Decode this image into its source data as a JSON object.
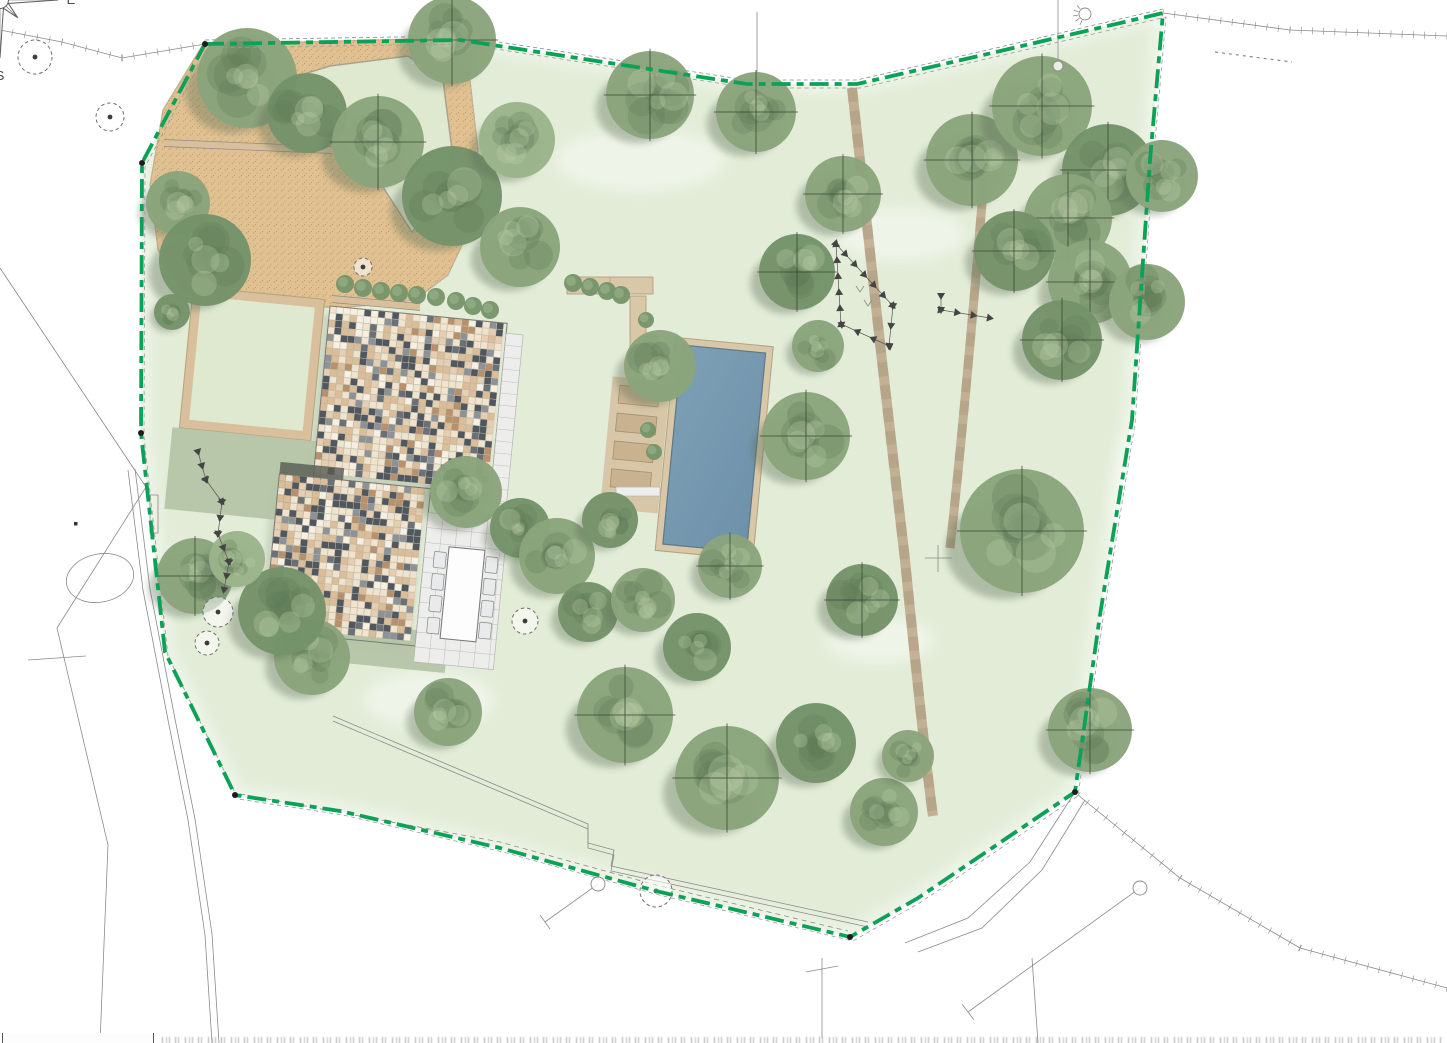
{
  "plan": {
    "kind": "landscape-garden-site-plan",
    "canvas": {
      "width": 1447,
      "height": 1043
    }
  },
  "compass": {
    "cx": 1362,
    "cy": 90,
    "rotation": -57,
    "r_long": 58,
    "r_short": 25,
    "labels": {
      "north": "Nord",
      "east": "E",
      "south": "S",
      "west": "O"
    }
  },
  "colors": {
    "lawn": "#e2ecd7",
    "lawn_island": "#dfe9d0",
    "boundary_green": "#0aa257",
    "boundary_companion": "#9a9a96",
    "gravel": "#e0c191",
    "gravel_edge": "#c3af92",
    "curb": "#a9a193",
    "sage": "#b5c4a6",
    "wall_tan": "#d9bf9b",
    "terrace": "#ededeb",
    "terrace_line": "#bdbdb9",
    "pool_water_a": "#7da0b6",
    "pool_water_b": "#6d91a9",
    "pool_edge": "#5d7888",
    "pool_deck": "#d9c8a8",
    "lounger": "#c9b28f",
    "lounger_edge": "#a58f6d",
    "path": "#b59c7d",
    "tree_base": "#8aa47c",
    "tree_dark": "#75936a",
    "tree_light": "#9bb48b",
    "tree_blotch": "#5f7a55",
    "tree_highlight": "#bdd2a8",
    "tree_shadow": "#5c6e57",
    "roof_palette": [
      "#f1e3cd",
      "#ddbd98",
      "#e7cdb2",
      "#52575f",
      "#8e9297",
      "#b9906b",
      "#f7efe2",
      "#6b7078"
    ],
    "roof_weights": [
      22,
      20,
      14,
      16,
      6,
      8,
      8,
      6
    ],
    "survey_line": "#8a8a8a",
    "marker": "#444444",
    "compass_line": "#5f5f5f"
  },
  "boundary": {
    "points": [
      [
        205,
        44
      ],
      [
        460,
        40
      ],
      [
        747,
        84
      ],
      [
        857,
        84
      ],
      [
        983,
        55
      ],
      [
        1163,
        13
      ],
      [
        1150,
        160
      ],
      [
        1132,
        420
      ],
      [
        1100,
        615
      ],
      [
        1075,
        792
      ],
      [
        918,
        898
      ],
      [
        850,
        937
      ],
      [
        656,
        891
      ],
      [
        500,
        848
      ],
      [
        340,
        811
      ],
      [
        235,
        795
      ],
      [
        165,
        652
      ],
      [
        141,
        433
      ],
      [
        142,
        163
      ]
    ],
    "vertex_dots": [
      [
        205,
        44
      ],
      [
        142,
        163
      ],
      [
        141,
        433
      ],
      [
        235,
        795
      ],
      [
        850,
        937
      ],
      [
        1075,
        792
      ]
    ],
    "dash": "19 6 7 6"
  },
  "lawn_patches": [
    [
      640,
      160,
      170,
      62
    ],
    [
      900,
      235,
      130,
      52
    ],
    [
      1155,
      500,
      85,
      170
    ],
    [
      430,
      700,
      130,
      55
    ],
    [
      880,
      640,
      110,
      45
    ]
  ],
  "driveway": {
    "outline": [
      [
        202,
        46
      ],
      [
        300,
        42
      ],
      [
        448,
        38
      ],
      [
        470,
        80
      ],
      [
        478,
        150
      ],
      [
        470,
        228
      ],
      [
        448,
        275
      ],
      [
        415,
        300
      ],
      [
        340,
        308
      ],
      [
        255,
        302
      ],
      [
        185,
        292
      ],
      [
        158,
        250
      ],
      [
        150,
        185
      ],
      [
        163,
        110
      ]
    ],
    "island": [
      [
        258,
        88
      ],
      [
        330,
        66
      ],
      [
        408,
        56
      ],
      [
        443,
        80
      ],
      [
        452,
        150
      ],
      [
        438,
        205
      ],
      [
        412,
        232
      ],
      [
        372,
        170
      ],
      [
        318,
        122
      ]
    ],
    "walls": [
      [
        [
          164,
          143
        ],
        [
          332,
          150
        ]
      ],
      [
        [
          332,
          299
        ],
        [
          420,
          307
        ]
      ]
    ]
  },
  "house": {
    "origin": [
      330,
      306
    ],
    "rotation": 5.6,
    "tile": 7,
    "roof_a": [
      0,
      0,
      178,
      172
    ],
    "roof_b": [
      -34,
      172,
      152,
      158
    ],
    "terrace_a": [
      178,
      10,
      17,
      170
    ],
    "terrace_b": [
      118,
      196,
      80,
      150
    ],
    "dark_strip": [
      -34,
      160,
      64,
      14
    ],
    "courtyard_outer": [
      -138,
      -6,
      132,
      142
    ],
    "courtyard_inner": [
      -129,
      3,
      114,
      124
    ],
    "sage_1": [
      -145,
      136,
      154,
      82
    ],
    "sage_2": [
      14,
      314,
      136,
      40
    ],
    "table": [
      142,
      228,
      36,
      92
    ],
    "chairs_y": [
      234,
      256,
      278,
      300
    ]
  },
  "pool": {
    "origin": [
      682,
      345
    ],
    "rotation": 5.5,
    "water": [
      0,
      0,
      84,
      200
    ],
    "deck": [
      -7,
      -7,
      98,
      214
    ],
    "lounger_deck": [
      -66,
      38,
      58,
      132
    ],
    "loungers": [
      [
        -58,
        46,
        40,
        18
      ],
      [
        -58,
        74,
        40,
        18
      ],
      [
        -58,
        102,
        40,
        18
      ],
      [
        -58,
        130,
        40,
        18
      ]
    ],
    "bench_top": [
      567,
      277,
      86,
      17
    ],
    "wall_v": [
      630,
      296,
      16,
      62
    ],
    "step_pad": [
      616,
      487,
      44,
      9
    ]
  },
  "paths": [
    {
      "d": "M852,88 C862,180 888,420 905,560 C918,690 928,780 933,816",
      "w": 10
    },
    {
      "d": "M988,126 C978,260 962,440 950,548",
      "w": 9
    }
  ],
  "trees": {
    "canopy": [
      [
        247,
        78,
        50,
        0,
        0
      ],
      [
        307,
        113,
        40,
        1,
        0
      ],
      [
        378,
        142,
        46,
        0,
        1
      ],
      [
        452,
        196,
        50,
        1,
        0
      ],
      [
        520,
        247,
        40,
        0,
        0
      ],
      [
        452,
        40,
        44,
        0,
        1
      ],
      [
        517,
        140,
        38,
        2,
        0
      ],
      [
        178,
        203,
        32,
        0,
        0
      ],
      [
        205,
        260,
        46,
        1,
        0
      ],
      [
        172,
        312,
        18,
        1,
        0
      ],
      [
        650,
        95,
        44,
        0,
        1
      ],
      [
        756,
        112,
        40,
        0,
        1
      ],
      [
        843,
        194,
        38,
        0,
        1
      ],
      [
        797,
        272,
        38,
        1,
        1
      ],
      [
        818,
        346,
        26,
        0,
        0
      ],
      [
        972,
        160,
        46,
        0,
        1
      ],
      [
        1042,
        106,
        50,
        0,
        1
      ],
      [
        1108,
        170,
        46,
        1,
        1
      ],
      [
        1162,
        176,
        36,
        0,
        0
      ],
      [
        1068,
        218,
        44,
        0,
        1
      ],
      [
        1014,
        251,
        40,
        1,
        1
      ],
      [
        1090,
        282,
        42,
        0,
        1
      ],
      [
        1147,
        302,
        38,
        0,
        0
      ],
      [
        1062,
        340,
        40,
        1,
        1
      ],
      [
        660,
        366,
        36,
        0,
        0
      ],
      [
        806,
        436,
        44,
        0,
        1
      ],
      [
        862,
        600,
        36,
        1,
        1
      ],
      [
        1022,
        531,
        62,
        0,
        1
      ],
      [
        730,
        566,
        32,
        0,
        1
      ],
      [
        466,
        492,
        36,
        0,
        0
      ],
      [
        520,
        528,
        30,
        1,
        0
      ],
      [
        557,
        556,
        38,
        0,
        0
      ],
      [
        610,
        520,
        28,
        1,
        0
      ],
      [
        588,
        612,
        30,
        1,
        0
      ],
      [
        643,
        600,
        32,
        0,
        0
      ],
      [
        697,
        647,
        34,
        1,
        0
      ],
      [
        625,
        715,
        48,
        0,
        1
      ],
      [
        727,
        778,
        52,
        0,
        1
      ],
      [
        816,
        743,
        40,
        1,
        0
      ],
      [
        884,
        812,
        34,
        0,
        0
      ],
      [
        908,
        756,
        26,
        0,
        0
      ],
      [
        1090,
        730,
        42,
        0,
        1
      ],
      [
        448,
        712,
        34,
        0,
        0
      ],
      [
        312,
        657,
        38,
        0,
        0
      ],
      [
        282,
        611,
        44,
        1,
        0
      ],
      [
        195,
        576,
        38,
        0,
        1
      ],
      [
        237,
        559,
        28,
        2,
        0
      ]
    ],
    "outline": [
      [
        35,
        57,
        17
      ],
      [
        110,
        117,
        14
      ],
      [
        363,
        267,
        9
      ],
      [
        525,
        621,
        13
      ],
      [
        218,
        612,
        15
      ],
      [
        207,
        643,
        12
      ],
      [
        656,
        891,
        16
      ]
    ]
  },
  "bush_rows": [
    {
      "r": 9,
      "pts": [
        [
          345,
          284
        ],
        [
          363,
          288
        ],
        [
          381,
          291
        ],
        [
          399,
          293
        ],
        [
          417,
          295
        ],
        [
          436,
          297
        ]
      ]
    },
    {
      "r": 9,
      "pts": [
        [
          456,
          301
        ],
        [
          473,
          306
        ],
        [
          490,
          310
        ]
      ]
    },
    {
      "r": 9,
      "pts": [
        [
          573,
          283
        ],
        [
          590,
          287
        ],
        [
          607,
          291
        ],
        [
          621,
          295
        ]
      ]
    },
    {
      "r": 8,
      "pts": [
        [
          646,
          320
        ],
        [
          651,
          342
        ]
      ]
    },
    {
      "r": 8,
      "pts": [
        [
          648,
          430
        ],
        [
          654,
          452
        ]
      ]
    }
  ],
  "triangle_lines": [
    {
      "p": [
        [
          836,
          244
        ],
        [
          893,
          306
        ],
        [
          889,
          346
        ],
        [
          841,
          324
        ],
        [
          836,
          244
        ]
      ]
    },
    {
      "p": [
        [
          941,
          296
        ],
        [
          941,
          310
        ],
        [
          990,
          318
        ]
      ]
    },
    {
      "p": [
        [
          198,
          452
        ],
        [
          206,
          480
        ],
        [
          222,
          502
        ],
        [
          218,
          534
        ],
        [
          229,
          562
        ],
        [
          224,
          590
        ]
      ]
    }
  ],
  "survey_lines": [
    {
      "p": [
        [
          0,
          30
        ],
        [
          62,
          42
        ],
        [
          122,
          58
        ],
        [
          205,
          44
        ]
      ],
      "hatch": 1
    },
    {
      "p": [
        [
          205,
          40
        ],
        [
          460,
          36
        ],
        [
          747,
          80
        ],
        [
          857,
          80
        ],
        [
          983,
          51
        ],
        [
          1163,
          9
        ]
      ],
      "dash": "4 3"
    },
    {
      "p": [
        [
          1163,
          13
        ],
        [
          1290,
          30
        ],
        [
          1447,
          36
        ]
      ],
      "hatch": 1
    },
    {
      "p": [
        [
          1215,
          52
        ],
        [
          1292,
          62
        ]
      ],
      "dash": "3 4",
      "w": 1.2
    },
    {
      "p": [
        [
          0,
          268
        ],
        [
          146,
          487
        ],
        [
          57,
          628
        ],
        [
          108,
          845
        ],
        [
          100,
          1043
        ]
      ]
    },
    {
      "p": [
        [
          128,
          470
        ],
        [
          143,
          590
        ],
        [
          168,
          720
        ],
        [
          188,
          820
        ],
        [
          205,
          935
        ],
        [
          212,
          1043
        ]
      ]
    },
    {
      "p": [
        [
          135,
          469
        ],
        [
          150,
          589
        ],
        [
          175,
          719
        ],
        [
          195,
          819
        ],
        [
          212,
          934
        ],
        [
          219,
          1043
        ]
      ]
    },
    {
      "p": [
        [
          28,
          660
        ],
        [
          86,
          656
        ]
      ]
    },
    {
      "p": [
        [
          333,
          716
        ],
        [
          588,
          824
        ],
        [
          588,
          843
        ],
        [
          614,
          850
        ],
        [
          611,
          866
        ],
        [
          868,
          922
        ]
      ],
      "dbl": [
        0,
        5
      ]
    },
    {
      "p": [
        [
          240,
          794
        ],
        [
          500,
          842
        ],
        [
          656,
          885
        ],
        [
          848,
          931
        ]
      ],
      "dash": "5 4"
    },
    {
      "p": [
        [
          1075,
          792
        ],
        [
          1030,
          862
        ],
        [
          968,
          918
        ],
        [
          905,
          943
        ]
      ]
    },
    {
      "p": [
        [
          1085,
          800
        ],
        [
          1042,
          870
        ],
        [
          982,
          928
        ],
        [
          918,
          952
        ]
      ]
    },
    {
      "p": [
        [
          1078,
          795
        ],
        [
          1180,
          878
        ],
        [
          1300,
          948
        ],
        [
          1447,
          988
        ]
      ],
      "hatch": 1
    },
    {
      "p": [
        [
          822,
          958
        ],
        [
          822,
          1038
        ]
      ]
    },
    {
      "p": [
        [
          806,
          972
        ],
        [
          838,
          966
        ]
      ]
    },
    {
      "p": [
        [
          1032,
          958
        ],
        [
          1038,
          1043
        ]
      ]
    },
    {
      "p": [
        [
          1058,
          0
        ],
        [
          1058,
          62
        ]
      ]
    },
    {
      "p": [
        [
          757,
          12
        ],
        [
          757,
          112
        ]
      ]
    },
    {
      "p": [
        [
          598,
          884
        ],
        [
          545,
          922
        ]
      ]
    },
    {
      "p": [
        [
          540,
          915
        ],
        [
          550,
          929
        ]
      ]
    },
    {
      "p": [
        [
          1140,
          888
        ],
        [
          968,
          1012
        ]
      ]
    },
    {
      "p": [
        [
          962,
          1004
        ],
        [
          974,
          1020
        ]
      ]
    },
    {
      "p": [
        [
          925,
          558
        ],
        [
          952,
          558
        ]
      ]
    },
    {
      "p": [
        [
          938,
          545
        ],
        [
          938,
          572
        ]
      ]
    },
    {
      "p": [
        [
          150,
          495
        ],
        [
          158,
          495
        ],
        [
          158,
          533
        ],
        [
          150,
          533
        ],
        [
          150,
          495
        ]
      ]
    },
    {
      "p": [
        [
          856,
          286
        ],
        [
          860,
          292
        ],
        [
          864,
          286
        ]
      ]
    },
    {
      "p": [
        [
          864,
          300
        ],
        [
          868,
          306
        ],
        [
          872,
          300
        ]
      ]
    }
  ],
  "survey_circles": [
    [
      1058,
      66,
      5
    ],
    [
      598,
      884,
      7
    ],
    [
      1140,
      888,
      7
    ]
  ],
  "lamp_symbol": [
    1085,
    14
  ],
  "small_square": [
    74,
    522
  ],
  "ellipse_marker": {
    "cx": 100,
    "cy": 578,
    "rx": 34,
    "ry": 24,
    "rot": -12
  }
}
